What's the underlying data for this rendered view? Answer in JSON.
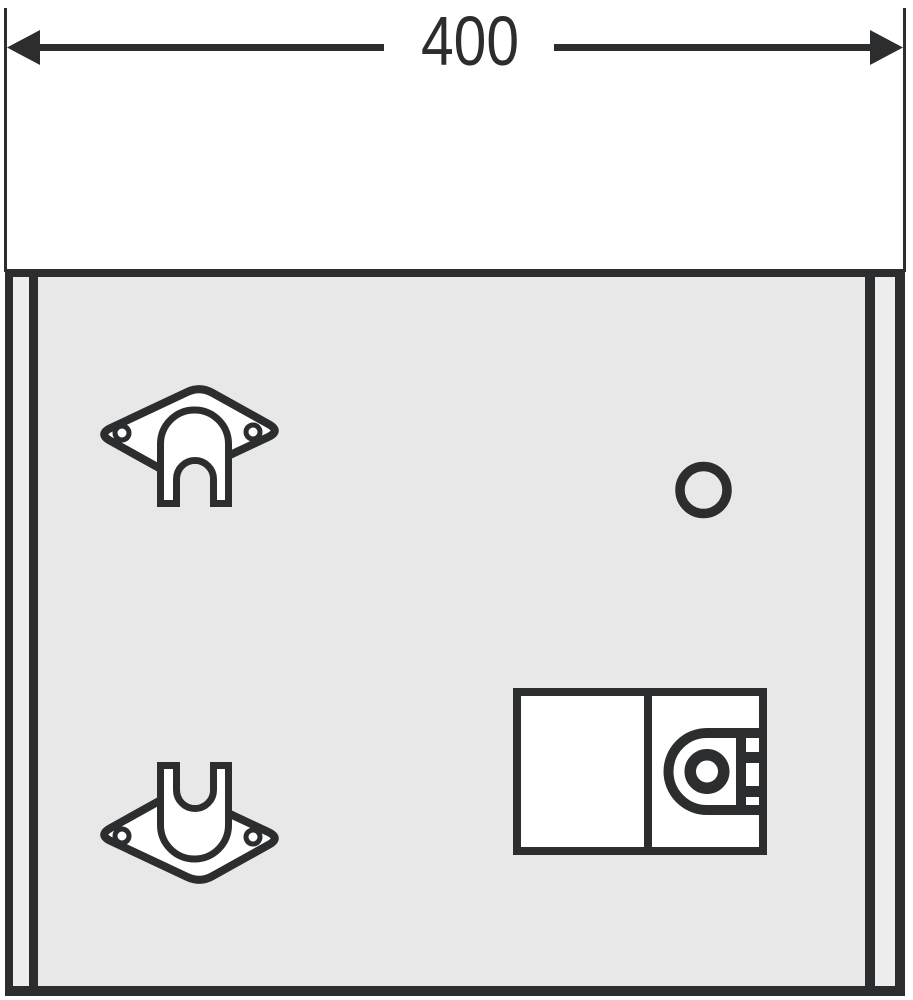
{
  "dimension": {
    "label": "400"
  },
  "colors": {
    "line": "#2b2d2e",
    "panel": "#e8e8e8",
    "side": "#ededed",
    "fill": "#ffffff"
  },
  "icons": {
    "arrow_left": "dimension-arrow-left",
    "arrow_right": "dimension-arrow-right",
    "bracket": "mounting-bracket",
    "hole": "round-hole",
    "lock": "cam-lock"
  }
}
